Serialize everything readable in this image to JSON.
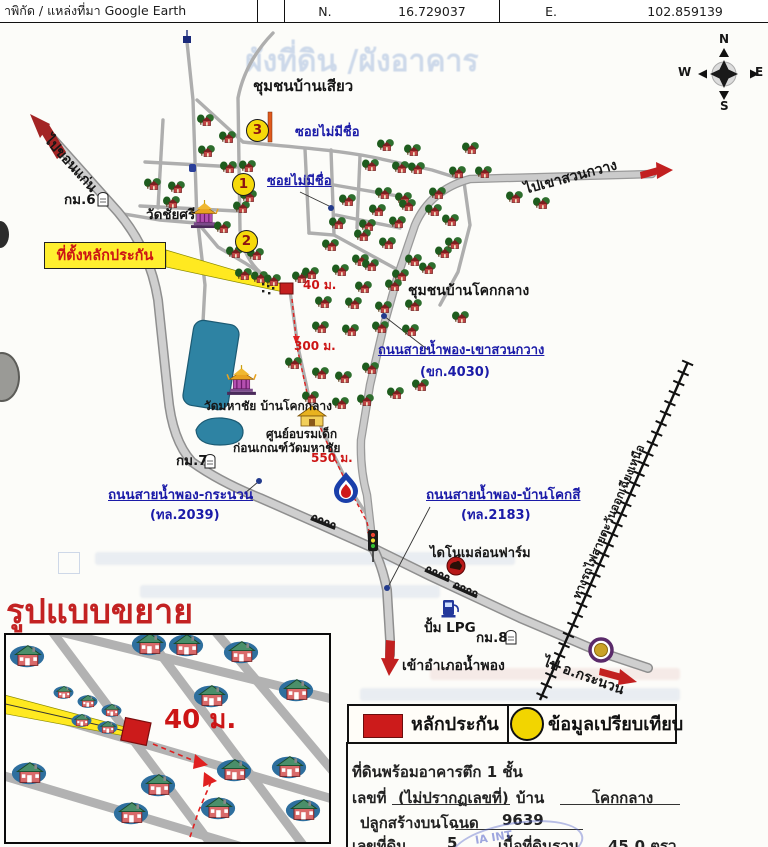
{
  "header": {
    "source": "าพิกัด / แหล่งที่มา Google Earth",
    "n_label": "N.",
    "n_value": "16.729037",
    "e_label": "E.",
    "e_value": "102.859139"
  },
  "compass": {
    "n": "N",
    "s": "S",
    "e": "E",
    "w": "W"
  },
  "map": {
    "watermark": "ผังที่ดิน /ผังอาคาร",
    "community_ban_siao": "ชุมชนบ้านเสียว",
    "community_ban_khok_klang": "ชุมชนบ้านโคกกลาง",
    "dir_khon_kaen": "ไปขอนแก่น",
    "dir_khao_suan_kwang": "ไปเขาสวนกวาง",
    "dir_kranuan": "ไป อ.กระนวน",
    "dir_nam_phong": "เข้าอำเภอน้ำพอง",
    "soi_unnamed_1": "ซอยไม่มีชื่อ",
    "soi_unnamed_2": "ซอยไม่มีชื่อ",
    "road_khao_suan_kwang": "ถนนสายน้ำพอง-เขาสวนกวาง",
    "road_khao_suan_kwang_no": "(ขก.4030)",
    "road_kranuan": "ถนนสายน้ำพอง-กระนวน",
    "road_kranuan_no": "(ทล.2039)",
    "road_khok_si": "ถนนสายน้ำพอง-บ้านโคกสี",
    "road_khok_si_no": "(ทล.2183)",
    "railway": "ทางรถไฟสายตะวันออกเฉียงเหนือ",
    "wat_chai_si": "วัดชัยศรี",
    "wat_mahachai": "วัดมหาชัย บ้านโคกกลาง",
    "child_center_1": "ศูนย์อบรมเด็ก",
    "child_center_2": "ก่อนเกณฑ์วัดมหาชัย",
    "dino_farm": "ไดโนเมล่อนฟาร์ม",
    "lpg": "ปั้ม LPG",
    "km6": "กม.6",
    "km7": "กม.7",
    "km8": "กม.8",
    "d40": "40 ม.",
    "d300": "300 ม.",
    "d550": "550 ม.",
    "banner": "ที่ตั้งหลักประกัน",
    "marker1": "1",
    "marker2": "2",
    "marker3": "3"
  },
  "inset": {
    "title": "รูปแบบขยาย",
    "d40": "40 ม."
  },
  "legend": {
    "collateral": "หลักประกัน",
    "comparison": "ข้อมูลเปรียบเทียบ"
  },
  "property": {
    "type": "ที่ดินพร้อมอาคารตึก 1 ชั้น",
    "no_label": "เลขที่",
    "no_value": "(ไม่ปรากฏเลขที่)",
    "village_label": "บ้าน",
    "village_value": "โคกกลาง",
    "deed_label": "ปลูกสร้างบนโฉนด",
    "deed_value": "9639",
    "land_label": "เลขที่ดิน",
    "land_value": "5",
    "area_label": "เนื้อที่ดินรวม",
    "area_value": "45.0 ตรว."
  },
  "stamp": "IA INT",
  "colors": {
    "accent_red": "#cc2222",
    "label_blue": "#1b1ba8",
    "banner_yellow": "#ffef2f",
    "marker_yellow": "#f5d90a",
    "pond": "#2e83a3"
  }
}
